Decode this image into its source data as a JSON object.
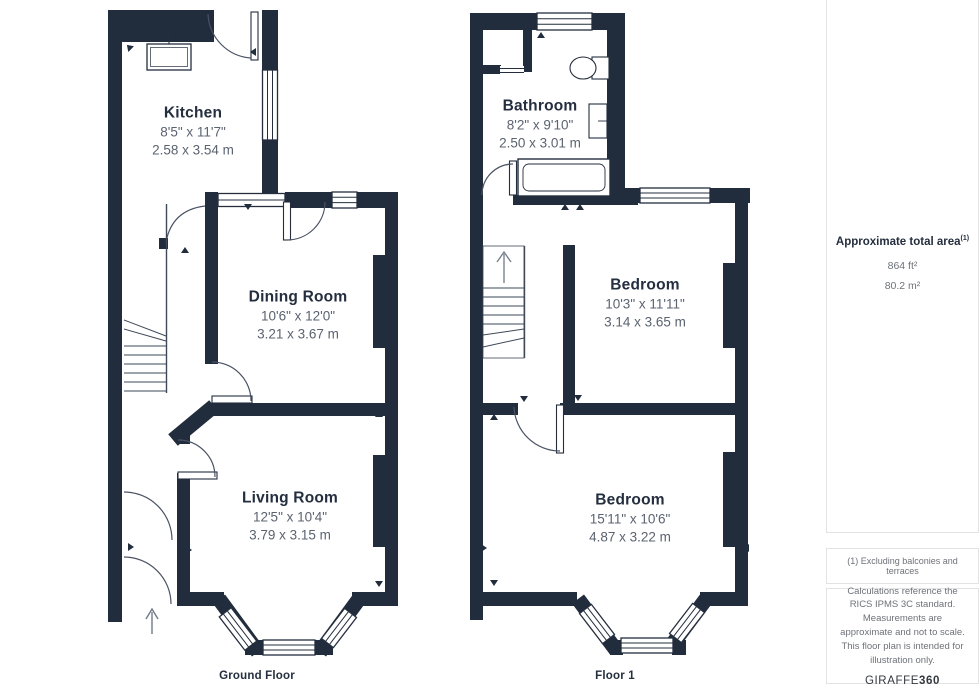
{
  "floors": [
    {
      "caption": "Ground Floor",
      "rooms": [
        {
          "name": "Kitchen",
          "imperial": "8'5\" x 11'7\"",
          "metric": "2.58 x 3.54 m"
        },
        {
          "name": "Dining Room",
          "imperial": "10'6\" x 12'0\"",
          "metric": "3.21 x 3.67 m"
        },
        {
          "name": "Living Room",
          "imperial": "12'5\" x 10'4\"",
          "metric": "3.79 x 3.15 m"
        }
      ]
    },
    {
      "caption": "Floor 1",
      "rooms": [
        {
          "name": "Bathroom",
          "imperial": "8'2\" x 9'10\"",
          "metric": "2.50 x 3.01 m"
        },
        {
          "name": "Bedroom",
          "imperial": "10'3\" x 11'11\"",
          "metric": "3.14 x 3.65 m"
        },
        {
          "name": "Bedroom",
          "imperial": "15'11\" x 10'6\"",
          "metric": "4.87 x 3.22 m"
        }
      ]
    }
  ],
  "side_panel": {
    "area_title": "Approximate total area",
    "area_title_sup": "(1)",
    "area_ft": "864 ft²",
    "area_m": "80.2 m²",
    "footnote": "(1) Excluding balconies and terraces",
    "disclaimer": "Calculations reference the RICS IPMS 3C standard. Measurements are approximate and not to scale. This floor plan is intended for illustration only.",
    "brand_name": "GIRAFFE",
    "brand_suffix": "360"
  },
  "colors": {
    "wall": "#212C3C",
    "outline": "#242E3E",
    "dim_text": "#5B6370",
    "muted_text": "#6E7278",
    "panel_border": "#E3E3E5"
  }
}
